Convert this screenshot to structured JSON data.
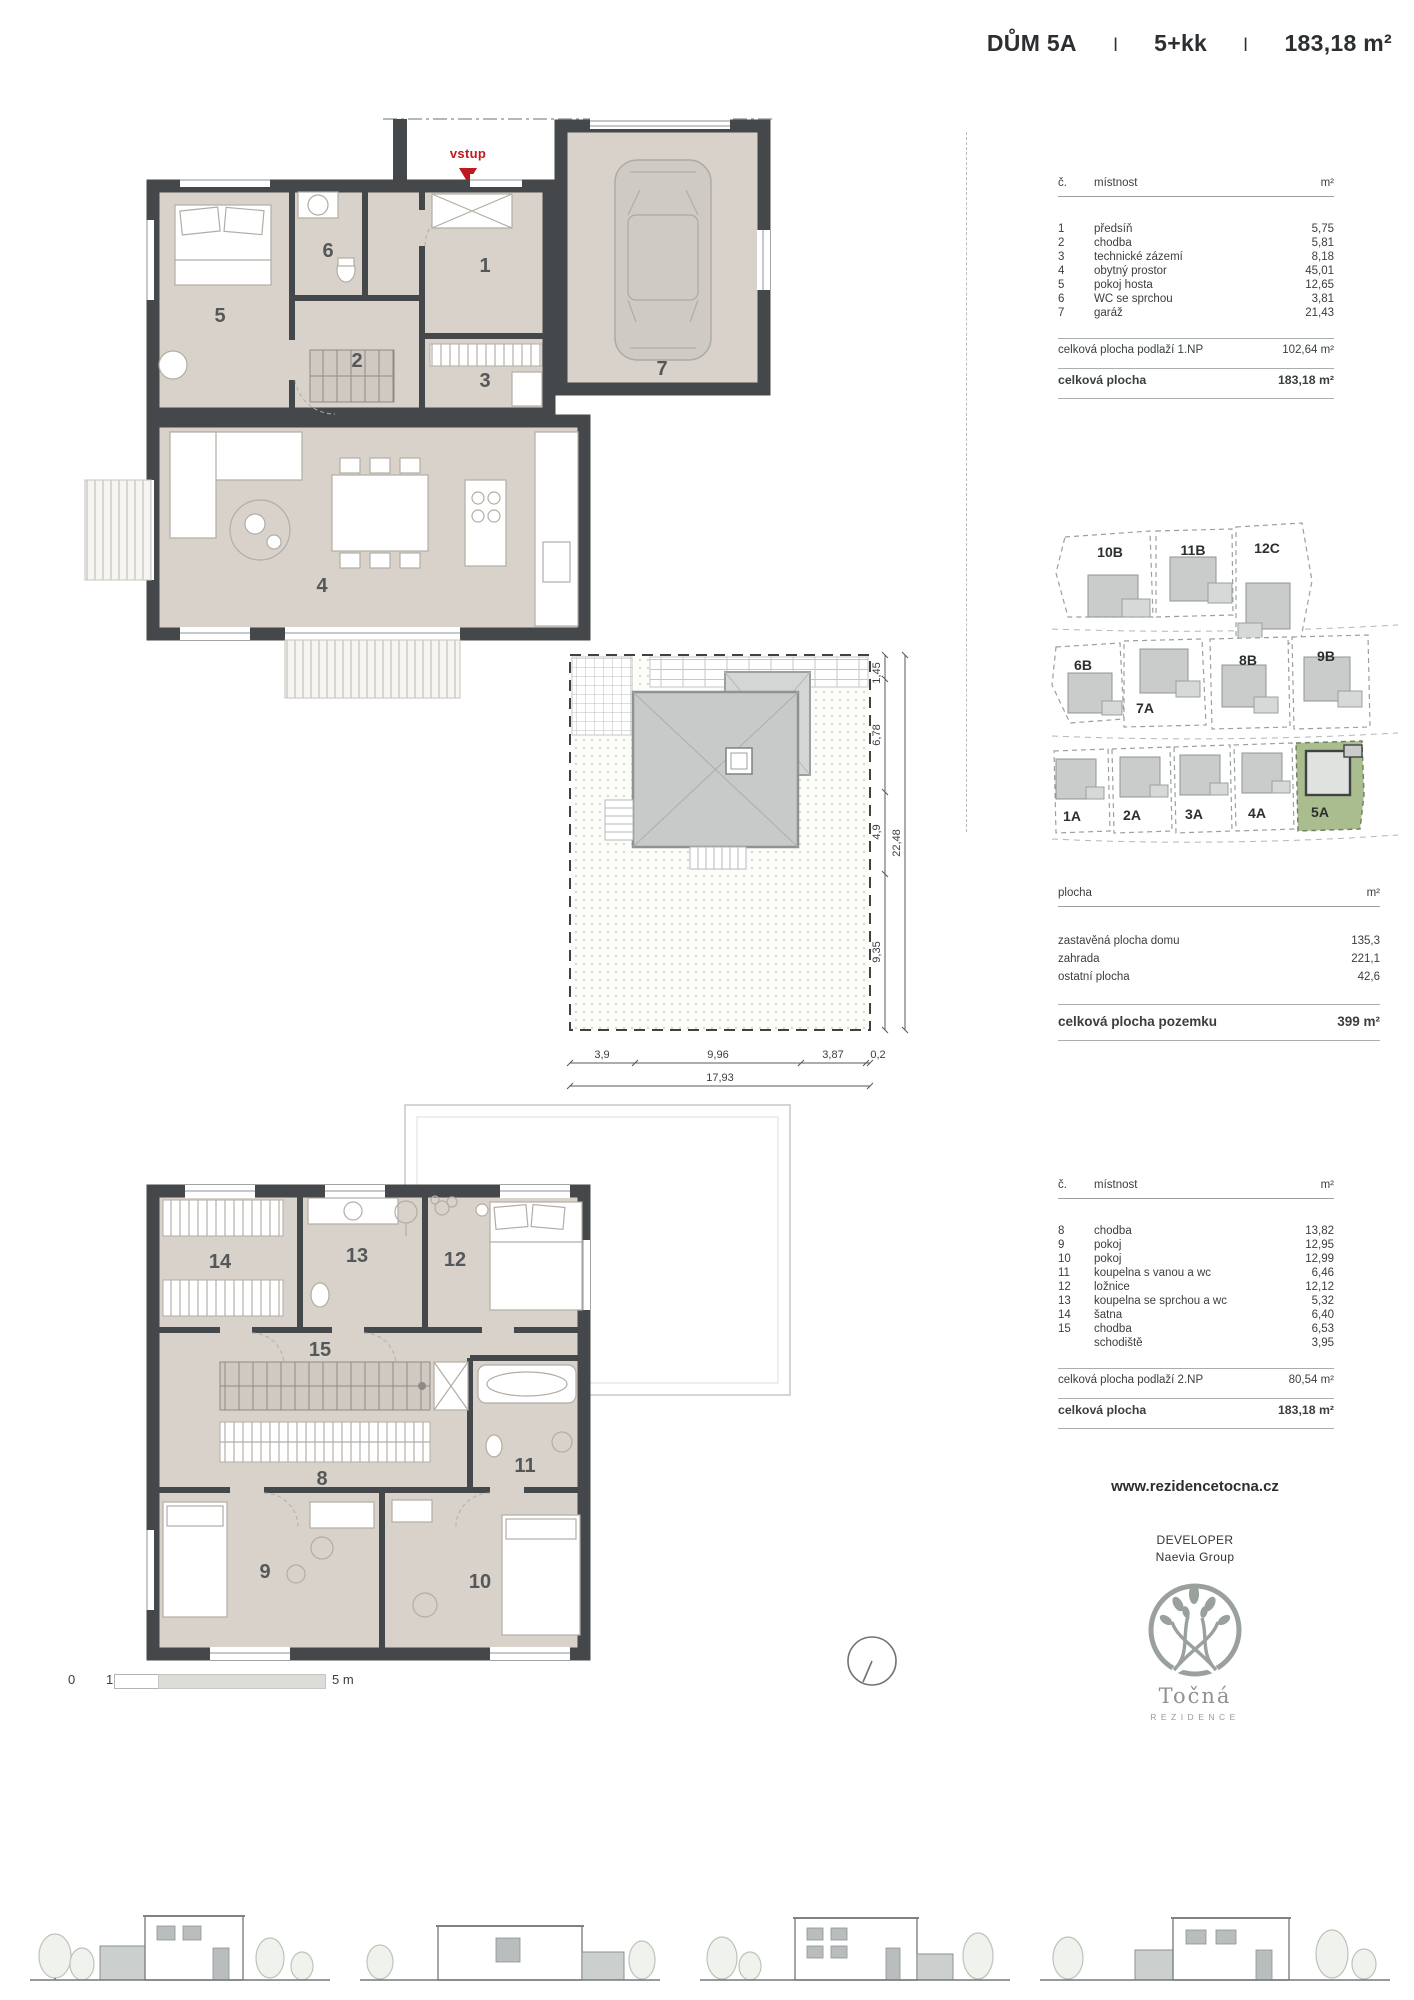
{
  "header": {
    "title_house": "DŮM 5A",
    "sep1": "I",
    "title_layout": "5+kk",
    "sep2": "I",
    "title_area": "183,18 m²"
  },
  "plan1": {
    "entrance_label": "vstup",
    "room_labels": {
      "r1": "1",
      "r2": "2",
      "r3": "3",
      "r4": "4",
      "r5": "5",
      "r6": "6",
      "r7": "7"
    }
  },
  "plan2": {
    "room_labels": {
      "r8": "8",
      "r9": "9",
      "r10": "10",
      "r11": "11",
      "r12": "12",
      "r13": "13",
      "r14": "14",
      "r15": "15"
    }
  },
  "site_plan": {
    "dims_vertical": [
      "1,45",
      "6,78",
      "4,9",
      "9,35"
    ],
    "dim_vertical_total": "22,48",
    "dims_horizontal": [
      "3,9",
      "9,96",
      "3,87",
      "0,2"
    ],
    "dim_horizontal_total": "17,93"
  },
  "site_map": {
    "lots": [
      "10B",
      "11B",
      "12C",
      "6B",
      "7A",
      "8B",
      "9B",
      "1A",
      "2A",
      "3A",
      "4A",
      "5A"
    ],
    "highlighted_lot": "5A"
  },
  "area_table_1np": {
    "col_no": "č.",
    "col_room": "místnost",
    "col_unit": "m²",
    "rows": [
      {
        "no": "1",
        "name": "předsíň",
        "area": "5,75"
      },
      {
        "no": "2",
        "name": "chodba",
        "area": "5,81"
      },
      {
        "no": "3",
        "name": "technické zázemí",
        "area": "8,18"
      },
      {
        "no": "4",
        "name": "obytný prostor",
        "area": "45,01"
      },
      {
        "no": "5",
        "name": "pokoj hosta",
        "area": "12,65"
      },
      {
        "no": "6",
        "name": "WC se sprchou",
        "area": "3,81"
      },
      {
        "no": "7",
        "name": "garáž",
        "area": "21,43"
      }
    ],
    "subtotal_label": "celková plocha podlaží 1.NP",
    "subtotal_value": "102,64 m²",
    "total_label": "celková plocha",
    "total_value": "183,18 m²"
  },
  "plot_table": {
    "col_name": "plocha",
    "col_unit": "m²",
    "rows": [
      {
        "name": "zastavěná plocha domu",
        "area": "135,3"
      },
      {
        "name": "zahrada",
        "area": "221,1"
      },
      {
        "name": "ostatní plocha",
        "area": "42,6"
      }
    ],
    "total_label": "celková plocha pozemku",
    "total_value": "399 m²"
  },
  "area_table_2np": {
    "col_no": "č.",
    "col_room": "místnost",
    "col_unit": "m²",
    "rows": [
      {
        "no": "8",
        "name": "chodba",
        "area": "13,82"
      },
      {
        "no": "9",
        "name": "pokoj",
        "area": "12,95"
      },
      {
        "no": "10",
        "name": "pokoj",
        "area": "12,99"
      },
      {
        "no": "11",
        "name": "koupelna s vanou a wc",
        "area": "6,46"
      },
      {
        "no": "12",
        "name": "ložnice",
        "area": "12,12"
      },
      {
        "no": "13",
        "name": "koupelna se sprchou a wc",
        "area": "5,32"
      },
      {
        "no": "14",
        "name": "šatna",
        "area": "6,40"
      },
      {
        "no": "15",
        "name": "chodba",
        "area": "6,53"
      },
      {
        "no": "",
        "name": "schodiště",
        "area": "3,95"
      }
    ],
    "subtotal_label": "celková plocha podlaží 2.NP",
    "subtotal_value": "80,54 m²",
    "total_label": "celková plocha",
    "total_value": "183,18 m²"
  },
  "footer": {
    "website": "www.rezidencetocna.cz",
    "developer_label": "DEVELOPER",
    "developer_name": "Naevia Group",
    "logo_title": "Točná",
    "logo_subtitle": "REZIDENCE"
  },
  "scale_bar": {
    "tick0": "0",
    "tick1": "1",
    "tick2": "2",
    "end_label": "5 m"
  },
  "colors": {
    "wall": "#45484a",
    "room_fill": "#d8d2ca",
    "accent_red": "#bf181d",
    "lot_highlight": "#a9bd8e"
  }
}
